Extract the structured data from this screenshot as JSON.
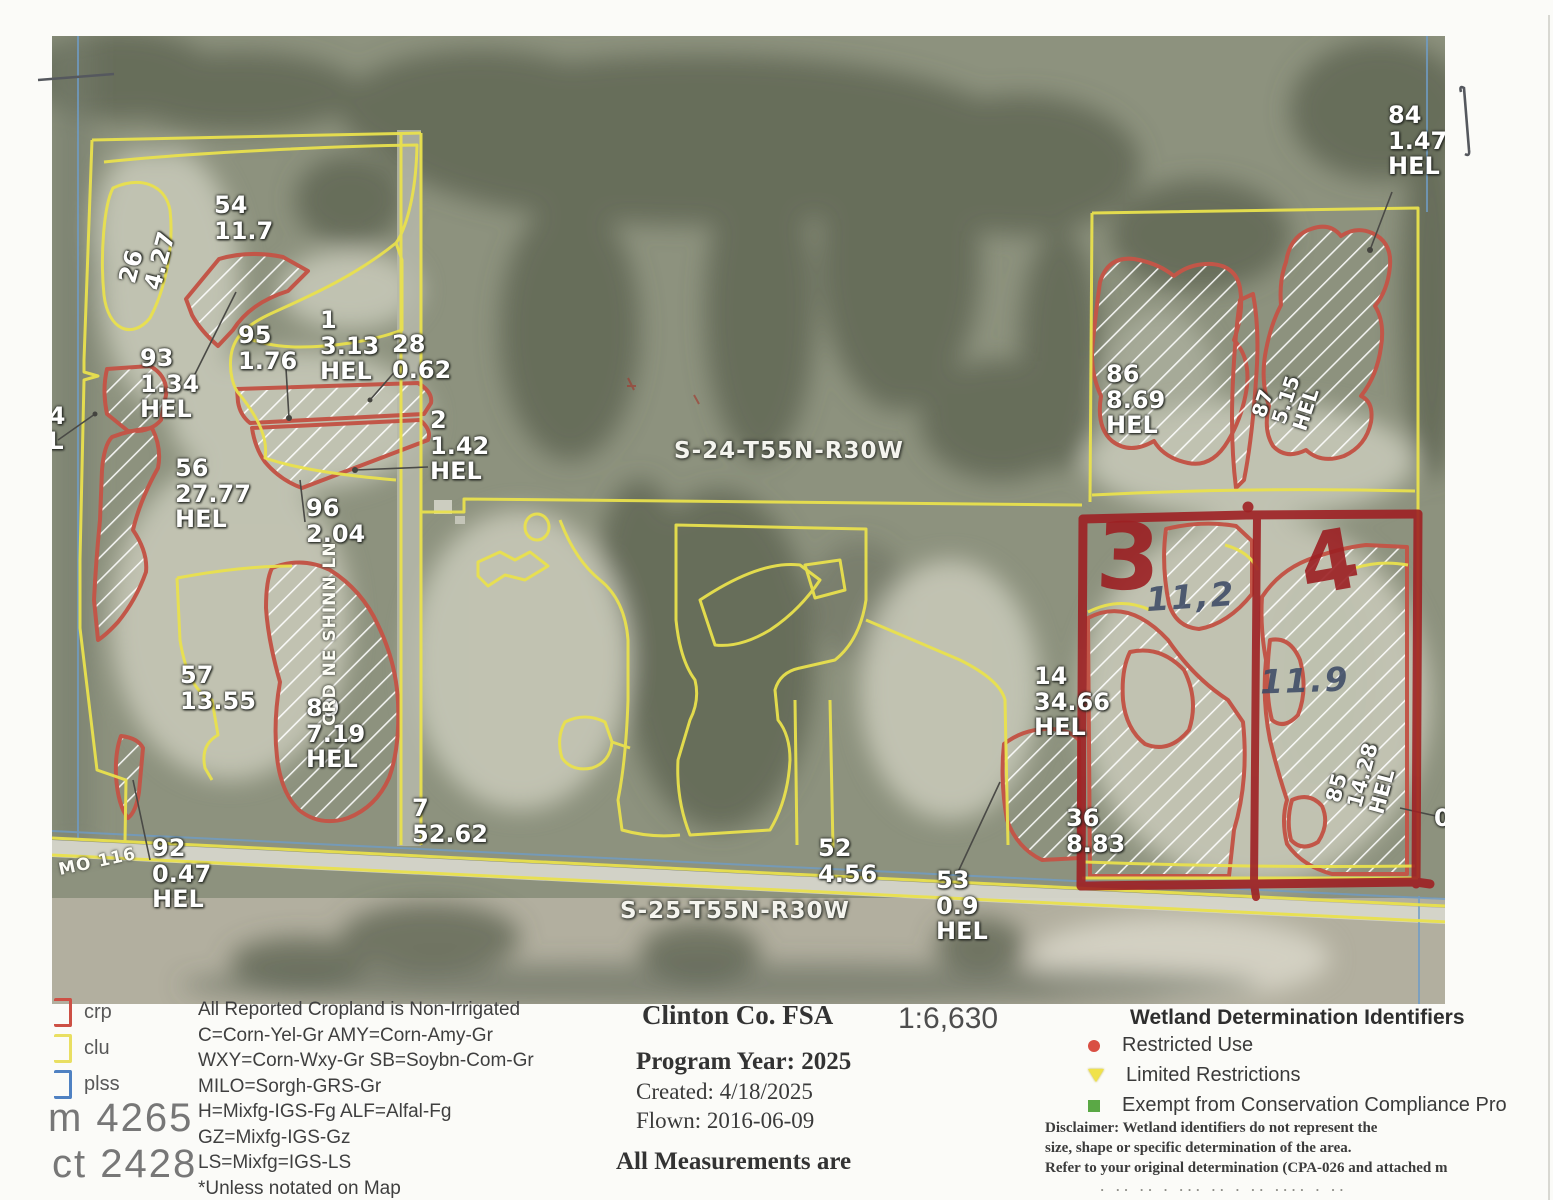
{
  "map": {
    "field_labels": [
      {
        "id": "54",
        "lines": [
          "54",
          "11.7"
        ],
        "x": 214,
        "y": 193
      },
      {
        "id": "26",
        "lines": [
          "26",
          "4.27"
        ],
        "x": 118,
        "y": 232,
        "rot": -75
      },
      {
        "id": "93",
        "lines": [
          "93",
          "1.34",
          "HEL"
        ],
        "x": 140,
        "y": 346
      },
      {
        "id": "95",
        "lines": [
          "95",
          "1.76"
        ],
        "x": 238,
        "y": 323
      },
      {
        "id": "1",
        "lines": [
          "1",
          "3.13",
          "HEL"
        ],
        "x": 320,
        "y": 308
      },
      {
        "id": "28",
        "lines": [
          "28",
          "0.62"
        ],
        "x": 392,
        "y": 332
      },
      {
        "id": "2",
        "lines": [
          "2",
          "1.42",
          "HEL"
        ],
        "x": 430,
        "y": 408
      },
      {
        "id": "56",
        "lines": [
          "56",
          "27.77",
          "HEL"
        ],
        "x": 175,
        "y": 456
      },
      {
        "id": "96",
        "lines": [
          "96",
          "2.04"
        ],
        "x": 306,
        "y": 496
      },
      {
        "id": "57",
        "lines": [
          "57",
          "13.55"
        ],
        "x": 180,
        "y": 663
      },
      {
        "id": "89",
        "lines": [
          "89",
          "7.19",
          "HEL"
        ],
        "x": 306,
        "y": 696
      },
      {
        "id": "92",
        "lines": [
          "92",
          "0.47",
          "HEL"
        ],
        "x": 152,
        "y": 836
      },
      {
        "id": "7",
        "lines": [
          "7",
          "52.62"
        ],
        "x": 412,
        "y": 796
      },
      {
        "id": "52",
        "lines": [
          "52",
          "4.56"
        ],
        "x": 818,
        "y": 836
      },
      {
        "id": "53",
        "lines": [
          "53",
          "0.9",
          "HEL"
        ],
        "x": 936,
        "y": 868
      },
      {
        "id": "14",
        "lines": [
          "14",
          "34.66",
          "HEL"
        ],
        "x": 1034,
        "y": 664
      },
      {
        "id": "36",
        "lines": [
          "36",
          "8.83"
        ],
        "x": 1066,
        "y": 806
      },
      {
        "id": "86",
        "lines": [
          "86",
          "8.69",
          "HEL"
        ],
        "x": 1106,
        "y": 362
      },
      {
        "id": "87",
        "lines": [
          "87",
          "5.15",
          "HEL"
        ],
        "x": 1262,
        "y": 368,
        "rot": -72,
        "fs": 20
      },
      {
        "id": "85",
        "lines": [
          "85",
          "14.28",
          "HEL"
        ],
        "x": 1330,
        "y": 742,
        "rot": -75,
        "fs": 21
      },
      {
        "id": "84",
        "lines": [
          "84",
          "1.47",
          "HEL"
        ],
        "x": 1388,
        "y": 103
      },
      {
        "id": "left-partial",
        "lines": [
          "0",
          "84",
          "EL"
        ],
        "x": 32,
        "y": 378
      },
      {
        "id": "right-partial",
        "lines": [
          "0"
        ],
        "x": 1434,
        "y": 806
      }
    ],
    "section_labels": [
      {
        "text": "S-24-T55N-R30W",
        "x": 674,
        "y": 438
      },
      {
        "text": "S-25-T55N-R30W",
        "x": 620,
        "y": 898
      }
    ],
    "road_labels": [
      {
        "text": "CRD NE SHINN LN",
        "x": 320,
        "y": 538,
        "rot": -90
      },
      {
        "text": "MO 116",
        "x": 58,
        "y": 852,
        "rot": -12
      }
    ],
    "annotations": [
      {
        "text": "3",
        "x": 1096,
        "y": 512,
        "cls": "marker-num",
        "rot": 2
      },
      {
        "text": "4",
        "x": 1300,
        "y": 520,
        "cls": "marker-num",
        "rot": -10,
        "fs": 84
      },
      {
        "text": "11,2",
        "x": 1146,
        "y": 580,
        "cls": "pen-num",
        "rot": -4
      },
      {
        "text": "11.9",
        "x": 1260,
        "y": 664,
        "cls": "pen-num",
        "rot": -2
      }
    ]
  },
  "legend": {
    "boundary_items": [
      {
        "label": "crp",
        "color": "#cd5045"
      },
      {
        "label": "clu",
        "color": "#e9df62"
      },
      {
        "label": "plss",
        "color": "#4f81c2"
      }
    ],
    "form_line": "m 4265",
    "tract_line": "ct 2428",
    "cropland_notes": [
      "All Reported Cropland is Non-Irrigated",
      "C=Corn-Yel-Gr    AMY=Corn-Amy-Gr",
      "WXY=Corn-Wxy-Gr    SB=Soybn-Com-Gr",
      "MILO=Sorgh-GRS-Gr",
      "H=Mixfg-IGS-Fg    ALF=Alfal-Fg",
      "GZ=Mixfg-IGS-Gz",
      "LS=Mixfg=IGS-LS",
      "*Unless notated on Map"
    ],
    "center": {
      "office": "Clinton Co. FSA",
      "scale": "1:6,630",
      "program_year": "Program Year: 2025",
      "created": "Created: 4/18/2025",
      "flown": "Flown: 2016-06-09",
      "measurements": "All Measurements are"
    },
    "wetland": {
      "title": "Wetland Determination Identifiers",
      "items": [
        {
          "icon": "red-dot",
          "label": "Restricted Use"
        },
        {
          "icon": "yellow-triangle",
          "label": "Limited Restrictions"
        },
        {
          "icon": "green-square",
          "label": "Exempt from Conservation Compliance Pro"
        }
      ],
      "disclaimer": [
        "Disclaimer: Wetland identifiers do not represent the",
        "size, shape or specific determination of the area.",
        "Refer to your original determination (CPA-026 and attached m"
      ],
      "fragment": "· ·· ·· · ··· ·· · ·· ···· · ··"
    }
  },
  "colors": {
    "crp": "#c25648",
    "clu": "#e9e14d",
    "plss": "#6f9cc6",
    "marker": "#9e2124",
    "pen": "#3d4a66"
  }
}
